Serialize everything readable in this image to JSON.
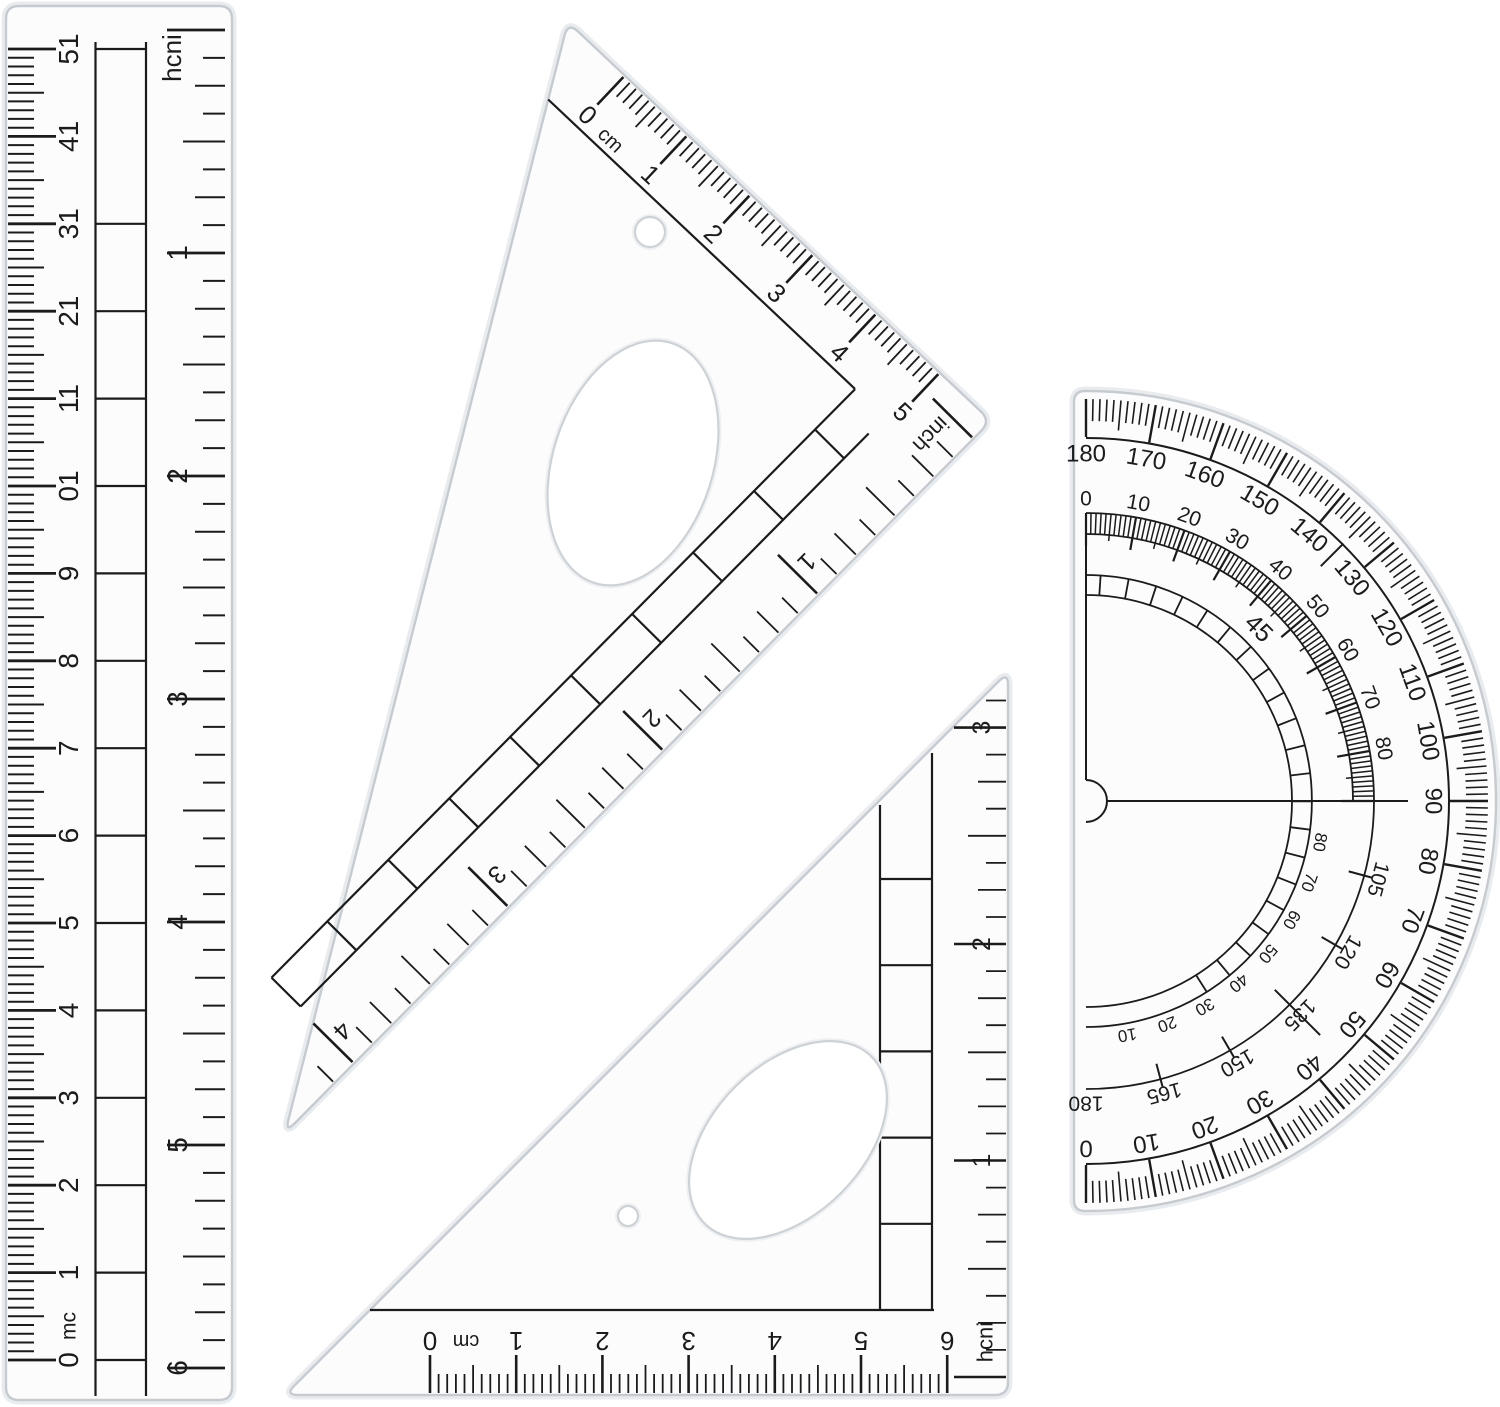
{
  "colors": {
    "background": "#ffffff",
    "ink": "#1b1b1b",
    "plastic_edge": "#c6cbd0",
    "plastic_halo": "#e9ecee",
    "plastic_fill": "#fcfcfd"
  },
  "ruler": {
    "cm_labels": [
      "0",
      "1",
      "2",
      "3",
      "4",
      "5",
      "6",
      "7",
      "8",
      "9",
      "10",
      "11",
      "12",
      "13",
      "14",
      "15"
    ],
    "cm_unit": "cm",
    "inch_label": "inch",
    "inch_labels": [
      "1",
      "2",
      "3",
      "4",
      "5",
      "6"
    ]
  },
  "triangle_large": {
    "cm_labels": [
      "0",
      "1",
      "2",
      "3",
      "4",
      "5"
    ],
    "cm_unit": "cm",
    "inch_label": "inch",
    "inch_labels": [
      "1",
      "2",
      "3",
      "4"
    ]
  },
  "triangle_small": {
    "cm_labels": [
      "0",
      "1",
      "2",
      "3",
      "4",
      "5",
      "6"
    ],
    "cm_unit": "cm",
    "inch_label": "inch",
    "inch_labels": [
      "1",
      "2",
      "3"
    ]
  },
  "protractor": {
    "outer": [
      "180",
      "170",
      "160",
      "150",
      "140",
      "130",
      "120",
      "110",
      "100",
      "90",
      "80",
      "70",
      "60",
      "50",
      "40",
      "30",
      "20",
      "10",
      "0"
    ],
    "middle_top": [
      "0",
      "10",
      "20",
      "30",
      "40",
      "50",
      "60",
      "70",
      "80"
    ],
    "middle_bottom": [
      "105",
      "120",
      "135",
      "150",
      "165",
      "180"
    ],
    "inner_top": "45",
    "inner_bottom": [
      "10",
      "20",
      "30",
      "40",
      "50",
      "60",
      "70",
      "80"
    ]
  }
}
